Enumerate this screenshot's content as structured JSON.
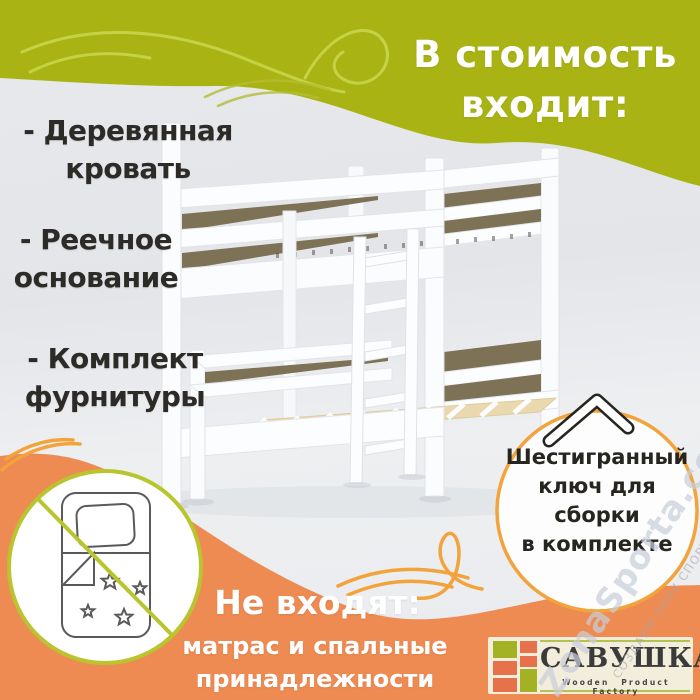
{
  "included": {
    "title": {
      "line1": "В стоимость",
      "line2": "входит:"
    },
    "items": [
      {
        "line1": "- Деревянная",
        "line2": "кровать"
      },
      {
        "line1": "- Реечное",
        "line2": "основание"
      },
      {
        "line1": "- Комплект",
        "line2": "фурнитуры"
      }
    ]
  },
  "hex_badge": {
    "line1": "Шестигранный",
    "line2": "ключ для",
    "line3": "сборки",
    "line4": "в комплекте"
  },
  "not_included": {
    "title": "Не входят:",
    "line1": "матрас и спальные",
    "line2": "принадлежности"
  },
  "logo": {
    "name": "САВУШКА",
    "tagline": "Wooden Product Factory"
  },
  "watermark": {
    "main": "ZonaSporta.com",
    "slogan": "СОЗДАЕМ ЗОНУ СПОРТА"
  },
  "icons": {
    "hex_key": "allen-key-icon",
    "no_bedding": "crossed-bedding-icon",
    "swirls": "decorative-swirl-lines"
  },
  "colors": {
    "green_band": "#a9b414",
    "green_swirl": "#ccd84f",
    "orange_band": "#ee8b52",
    "accent_orange": "#f2a33c",
    "accent_green": "#b9c52f",
    "bed_gap_brown": "#7d7156",
    "slat_cream": "#ead9ae",
    "logo_bg": "#f3eedb",
    "logo_green": "#a2b224",
    "logo_orange": "#e7714b",
    "text_dark": "#2d2b27",
    "text_white": "#ffffff"
  }
}
